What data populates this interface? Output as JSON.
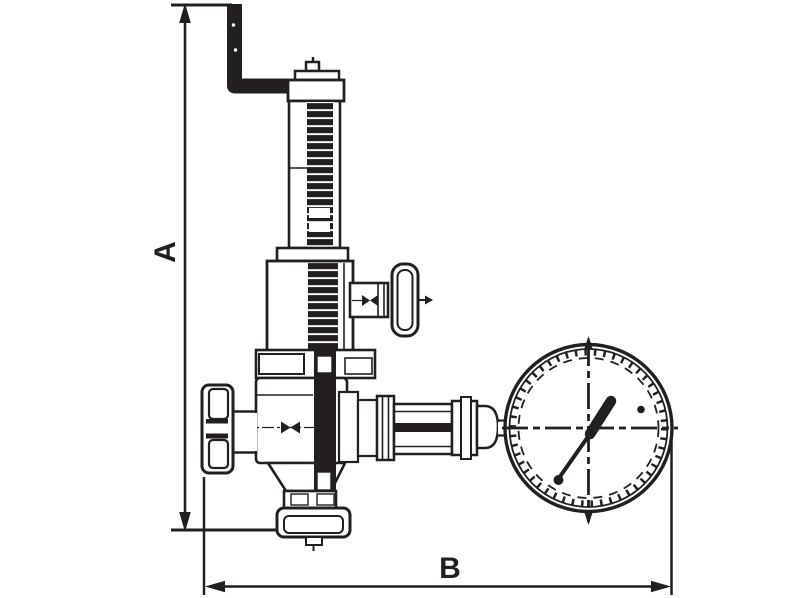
{
  "drawing": {
    "type": "technical-line-drawing",
    "subject": "spring-loaded valve with bent top pipe, side hand-wheel vent valve, flanged inlet and outlet, and pressure gauge",
    "line_color": "#231f20",
    "background_color": "#ffffff",
    "dimensions": [
      {
        "label": "A",
        "orientation": "vertical",
        "position": "left"
      },
      {
        "label": "B",
        "orientation": "horizontal",
        "position": "bottom"
      }
    ]
  }
}
